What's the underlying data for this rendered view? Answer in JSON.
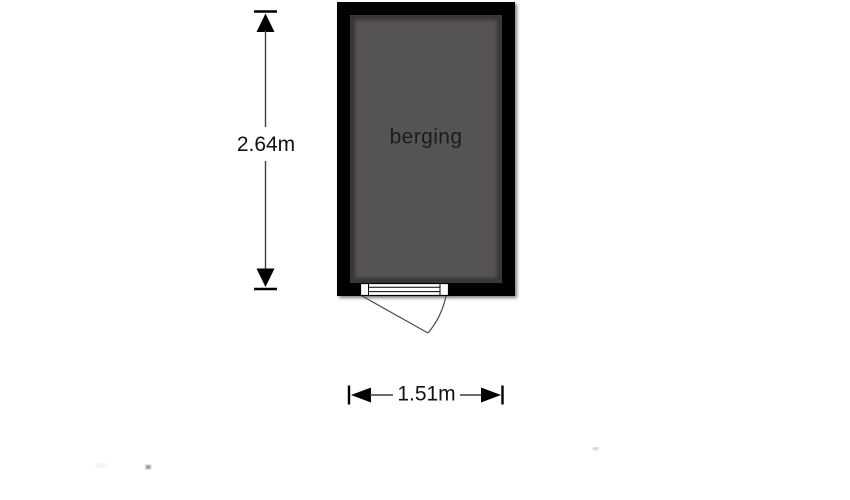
{
  "floorplan": {
    "room": {
      "label": "berging",
      "wall_color": "#000000",
      "floor_color": "#565356",
      "label_color": "#1c1c1c"
    },
    "dimensions": {
      "height_label": "2.64m",
      "width_label": "1.51m",
      "line_color": "#3d3d3d",
      "marker_color": "#000000",
      "text_color": "#111111"
    },
    "door": {
      "panel_color": "#ffffff",
      "swing_color": "#4a4a4a"
    },
    "background_color": "#ffffff"
  }
}
